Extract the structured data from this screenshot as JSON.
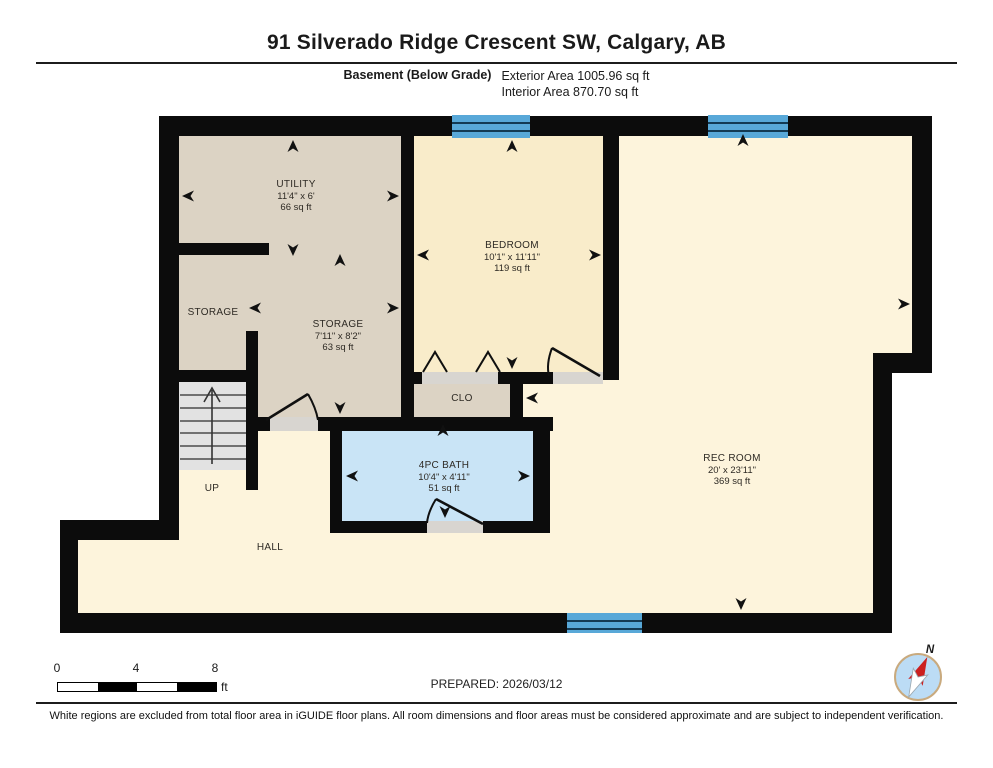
{
  "header": {
    "title": "91 Silverado Ridge Crescent SW, Calgary, AB",
    "floor_label": "Basement (Below Grade)",
    "exterior_area": "Exterior Area 1005.96 sq ft",
    "interior_area": "Interior Area 870.70 sq ft"
  },
  "rooms": {
    "utility": {
      "name": "UTILITY",
      "dims": "11'4\" x 6'",
      "area": "66 sq ft"
    },
    "storage_small": {
      "name": "STORAGE"
    },
    "storage": {
      "name": "STORAGE",
      "dims": "7'11\" x 8'2\"",
      "area": "63 sq ft"
    },
    "bedroom": {
      "name": "BEDROOM",
      "dims": "10'1\" x 11'11\"",
      "area": "119 sq ft"
    },
    "closet": {
      "name": "CLO"
    },
    "bath": {
      "name": "4PC BATH",
      "dims": "10'4\" x 4'11\"",
      "area": "51 sq ft"
    },
    "rec_room": {
      "name": "REC ROOM",
      "dims": "20' x 23'11\"",
      "area": "369 sq ft"
    },
    "hall": {
      "name": "HALL"
    },
    "stairs": {
      "label": "UP"
    }
  },
  "scale_bar": {
    "start": "0",
    "mid": "4",
    "end": "8",
    "unit": "ft"
  },
  "compass": {
    "label": "N"
  },
  "footer": {
    "prepared": "PREPARED: 2026/03/12",
    "disclaimer": "White regions are excluded from total floor area in iGUIDE floor plans. All room dimensions and floor areas must be considered approximate and are subject to independent verification."
  },
  "colors": {
    "wall": "#0c0c0c",
    "room_tan": "#dcd3c4",
    "room_cream": "#f9ecca",
    "room_pale": "#fdf4dc",
    "bath_blue": "#c9e4f6",
    "window_blue": "#58a8d8",
    "stairs_gray": "#e2e2e2"
  }
}
